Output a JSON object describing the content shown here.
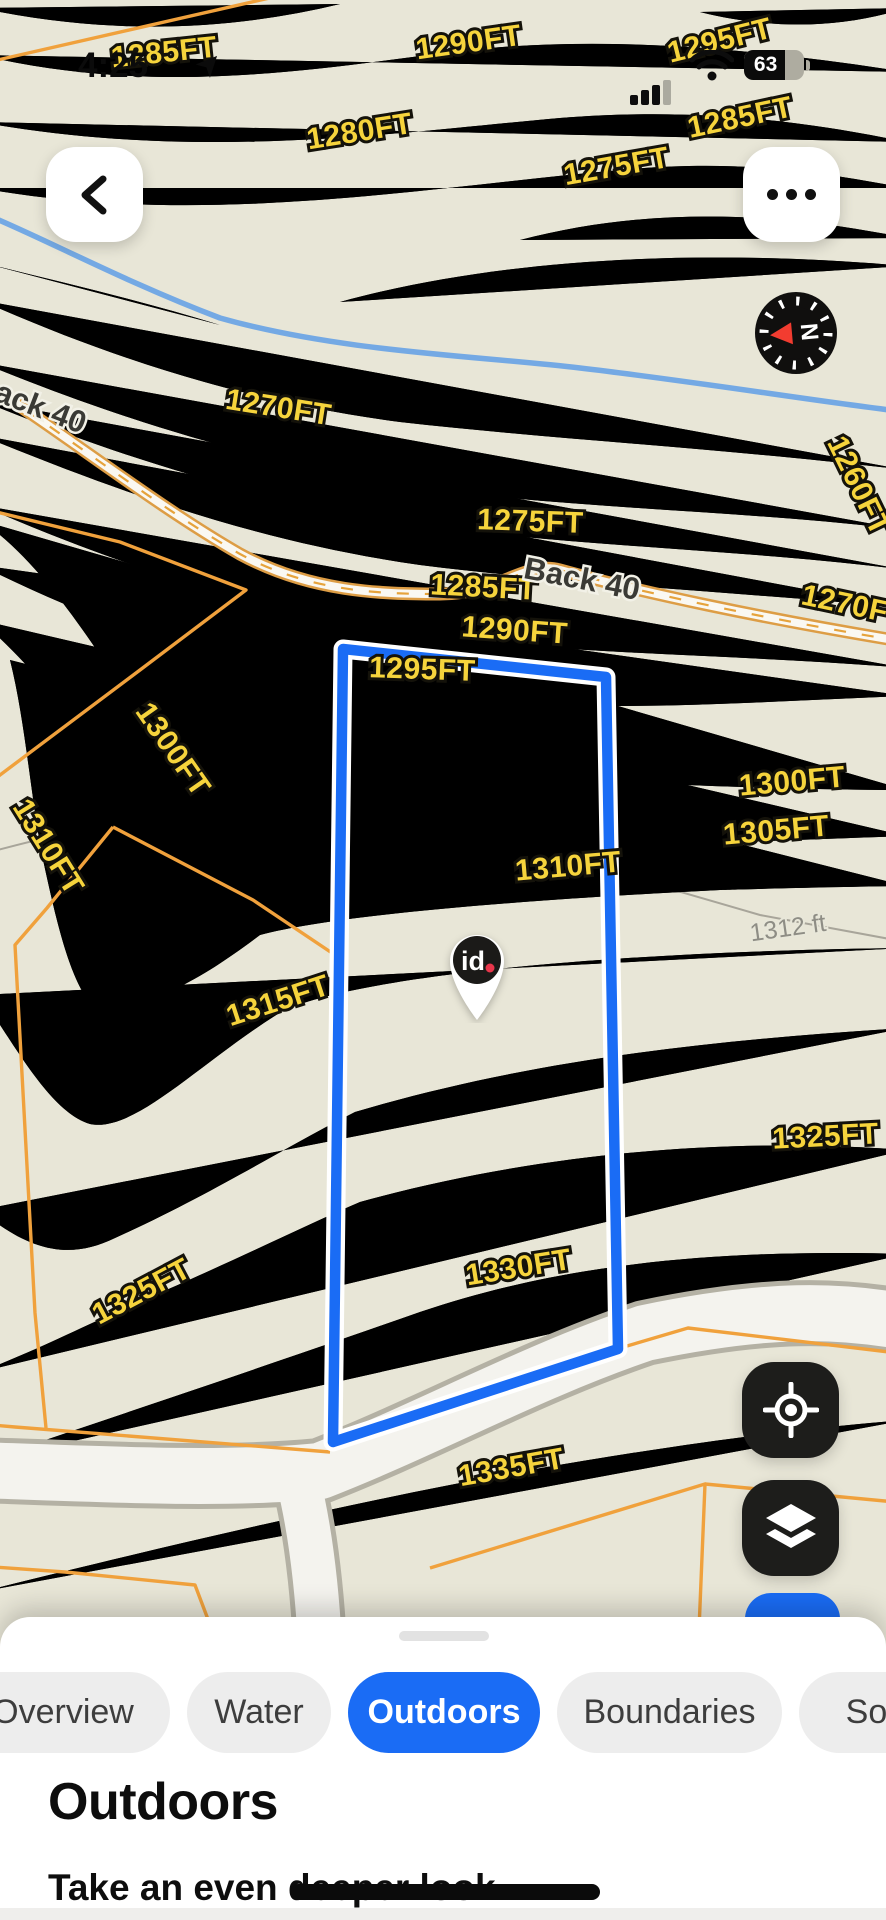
{
  "status_bar": {
    "time": "4:25",
    "location_arrow_icon": "location-arrow",
    "signal_icon": "cellular-signal-3-of-4",
    "wifi_icon": "wifi",
    "battery_percent": "63"
  },
  "map": {
    "labels": [
      {
        "text": "1285FT"
      },
      {
        "text": "1290FT"
      },
      {
        "text": "1295FT"
      },
      {
        "text": "1280FT"
      },
      {
        "text": "1285FT"
      },
      {
        "text": "1275FT"
      },
      {
        "text": "1270FT"
      },
      {
        "text": "1260FT"
      },
      {
        "text": "1275FT"
      },
      {
        "text": "1285FT"
      },
      {
        "text": "1270FT"
      },
      {
        "text": "1290FT"
      },
      {
        "text": "1295FT"
      },
      {
        "text": "1300FT"
      },
      {
        "text": "1300FT"
      },
      {
        "text": "1305FT"
      },
      {
        "text": "1310FT"
      },
      {
        "text": "1310FT"
      },
      {
        "text": "1315FT"
      },
      {
        "text": "1325FT"
      },
      {
        "text": "1330FT"
      },
      {
        "text": "1325FT"
      },
      {
        "text": "1335FT"
      },
      {
        "text": "ack 40"
      },
      {
        "text": "Back 40"
      },
      {
        "text": "1312 ft"
      }
    ],
    "pin": {
      "text": "id",
      "dot": "."
    },
    "compass_letter": "N",
    "colors": {
      "parcel_boundary": "#1a6cf5",
      "contour": "#d2a72e",
      "elevation_label": "#f6d43c",
      "stream": "#74a9e4",
      "secondary_line": "#f0a13c"
    }
  },
  "sheet": {
    "tabs": [
      {
        "label": "Overview",
        "active": false
      },
      {
        "label": "Water",
        "active": false
      },
      {
        "label": "Outdoors",
        "active": true
      },
      {
        "label": "Boundaries",
        "active": false
      },
      {
        "label": "Soil",
        "active": false
      }
    ],
    "heading": "Outdoors",
    "subtitle": "Take an even deeper look"
  }
}
